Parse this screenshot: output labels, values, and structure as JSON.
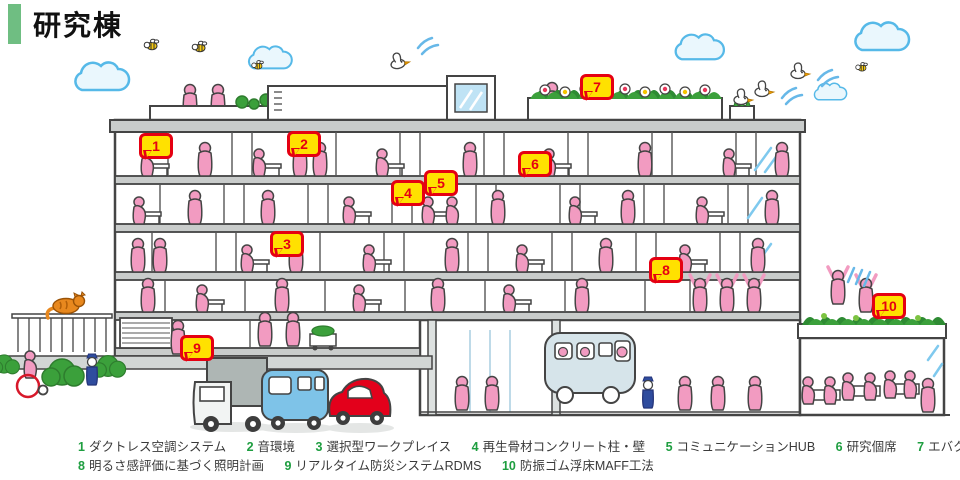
{
  "header": {
    "title": "研究棟"
  },
  "features": [
    {
      "number": "1",
      "label": "ダクトレス空調システム"
    },
    {
      "number": "2",
      "label": "音環境"
    },
    {
      "number": "3",
      "label": "選択型ワークプレイス"
    },
    {
      "number": "4",
      "label": "再生骨材コンクリート柱・壁"
    },
    {
      "number": "5",
      "label": "コミュニケーションHUB"
    },
    {
      "number": "6",
      "label": "研究個席"
    },
    {
      "number": "7",
      "label": "エバクールガーデン"
    },
    {
      "number": "8",
      "label": "明るさ感評価に基づく照明計画"
    },
    {
      "number": "9",
      "label": "リアルタイム防災システムRDMS"
    },
    {
      "number": "10",
      "label": "防振ゴム浮床MAFF工法"
    }
  ],
  "colors": {
    "title_accent_green": "#6FBE82",
    "legend_number_green": "#1E9E40",
    "marker_fill_yellow": "#FFE100",
    "marker_border_red": "#E50012",
    "people_pink": "#F29BC1",
    "sky_blue": "#56B9E8",
    "plant_green": "#3BA03B"
  }
}
